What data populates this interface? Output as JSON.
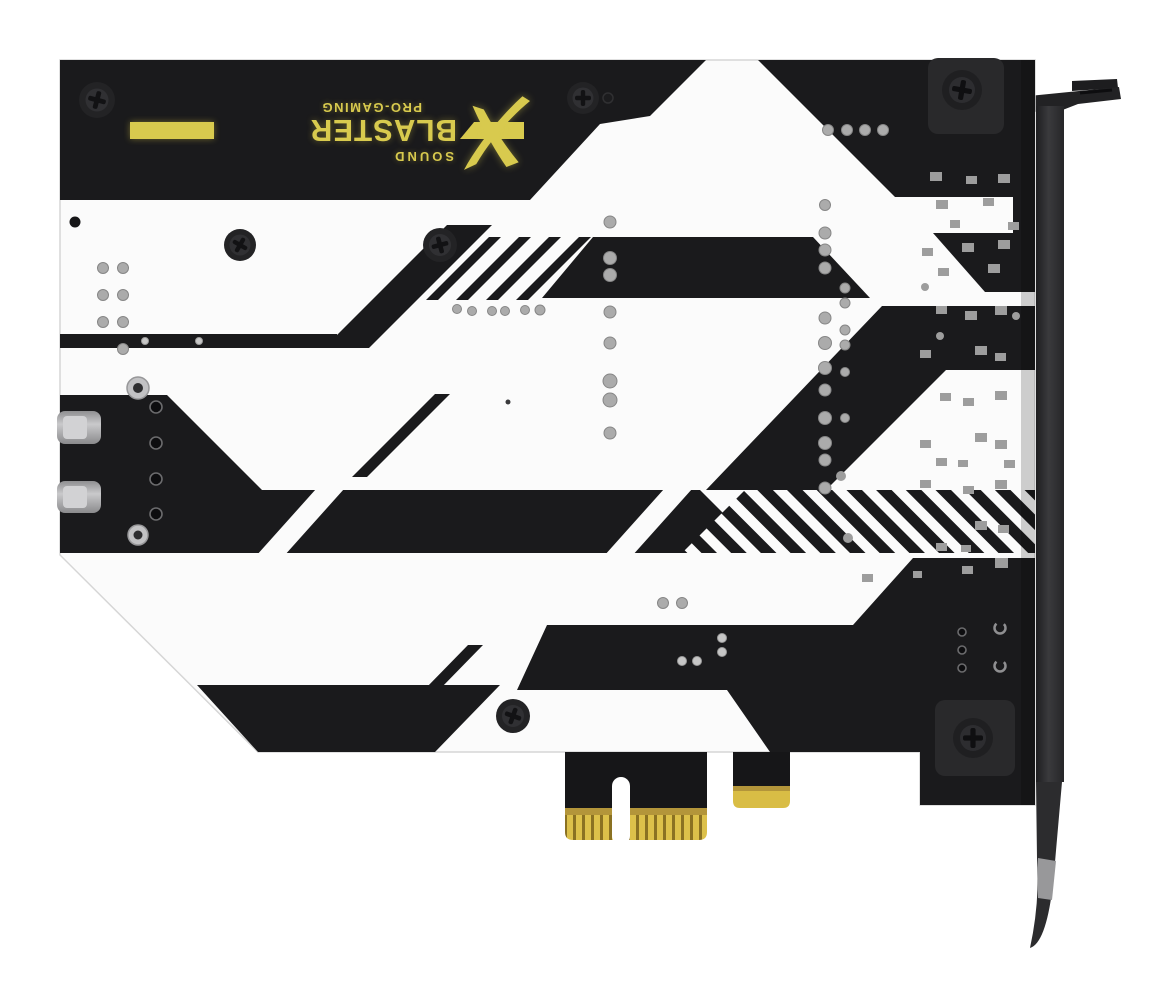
{
  "product": {
    "logo": {
      "sound": "SOUND",
      "blaster": "BLASTER",
      "x": "X",
      "tagline": "PRO-GAMING"
    }
  },
  "colors": {
    "board_black": "#1a1a1c",
    "board_white": "#fbfbfb",
    "logo_yellow": "#d8ca4e",
    "connector_gold": "#dcc04a",
    "gold_shadow": "#8a7122",
    "bracket_gray": "#2b2b2d",
    "via_gray": "#ababab",
    "background": "#ffffff"
  },
  "icons": {
    "screws": "phillips-screw-icon",
    "logo_mark": "blasterx-x-icon"
  }
}
